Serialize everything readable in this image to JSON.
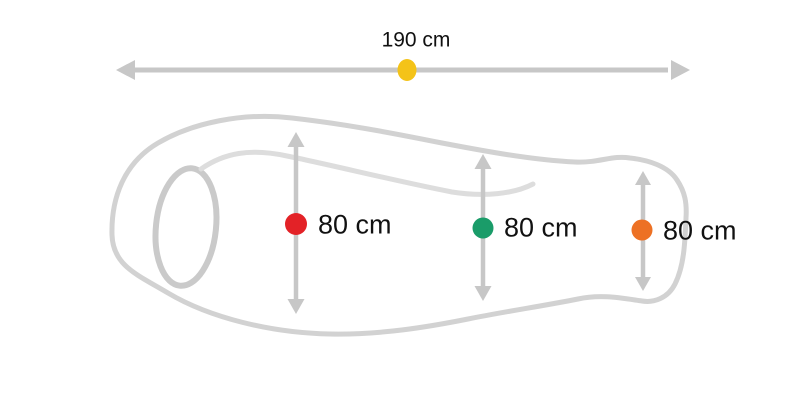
{
  "diagram": {
    "subject": "sleeping-bag-dimensions-diagram",
    "length": {
      "label": "190 cm",
      "value_cm": 190,
      "marker_color": "#F4C318"
    },
    "widths": [
      {
        "id": "left",
        "label": "80 cm",
        "value_cm": 80,
        "marker_color": "#E32227"
      },
      {
        "id": "middle",
        "label": "80 cm",
        "value_cm": 80,
        "marker_color": "#1A9C69"
      },
      {
        "id": "right",
        "label": "80 cm",
        "value_cm": 80,
        "marker_color": "#ED7124"
      }
    ],
    "colors": {
      "arrow_gray": "#C7C7C7",
      "outline_gray": "#D2D2D2",
      "collar_gray": "#DDDDDD",
      "hood_gray": "#CACACA",
      "text": "#111111",
      "background": "#FFFFFF"
    }
  }
}
